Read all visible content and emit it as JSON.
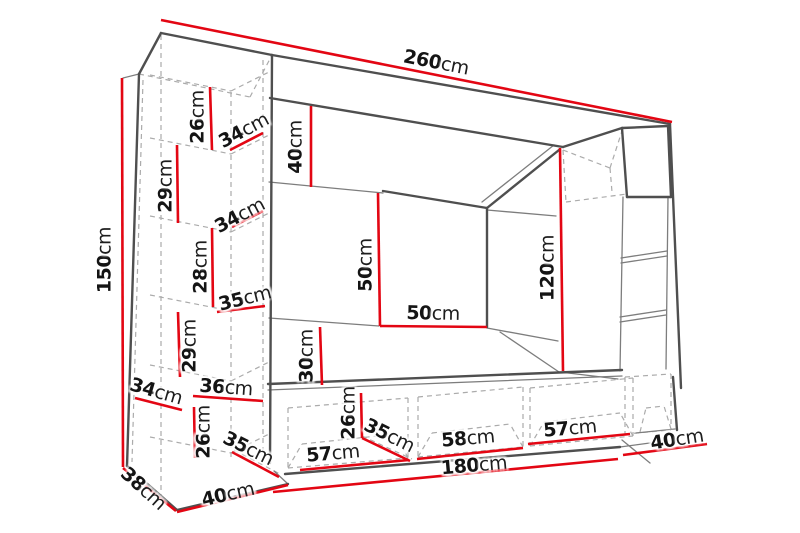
{
  "diagram": {
    "type": "furniture-dimension-drawing",
    "subject": "wall unit entertainment center with left shelf column, top panel, hanging cabinet, TV back panel and base cabinets",
    "unit": "cm",
    "colors": {
      "dimension_line": "#e30613",
      "outline": "#4f4f4f",
      "secondary_line": "#7d7d7d",
      "hidden_line": "#ababab",
      "text": "#141414",
      "background": "#ffffff"
    }
  },
  "labels": [
    {
      "name": "total-width",
      "value": "260",
      "unit": "cm"
    },
    {
      "name": "total-height",
      "value": "150",
      "unit": "cm"
    },
    {
      "name": "left-top-shelf-height",
      "value": "26",
      "unit": "cm"
    },
    {
      "name": "top-shelf-depth",
      "value": "34",
      "unit": "cm"
    },
    {
      "name": "top-panel-height",
      "value": "40",
      "unit": "cm"
    },
    {
      "name": "left-shelf-2-height",
      "value": "29",
      "unit": "cm"
    },
    {
      "name": "shelf-depth-2",
      "value": "34",
      "unit": "cm"
    },
    {
      "name": "left-shelf-3-height",
      "value": "28",
      "unit": "cm"
    },
    {
      "name": "shelf-depth-3",
      "value": "35",
      "unit": "cm"
    },
    {
      "name": "left-shelf-4-height",
      "value": "29",
      "unit": "cm"
    },
    {
      "name": "tv-panel-height",
      "value": "50",
      "unit": "cm"
    },
    {
      "name": "tv-panel-width",
      "value": "50",
      "unit": "cm"
    },
    {
      "name": "right-opening-height",
      "value": "120",
      "unit": "cm"
    },
    {
      "name": "middle-gap-height",
      "value": "30",
      "unit": "cm"
    },
    {
      "name": "bottom-left-shelf-depth",
      "value": "34",
      "unit": "cm"
    },
    {
      "name": "bottom-left-shelf-width",
      "value": "36",
      "unit": "cm"
    },
    {
      "name": "left-bottom-shelf-height",
      "value": "26",
      "unit": "cm"
    },
    {
      "name": "bottom-left-depth",
      "value": "35",
      "unit": "cm"
    },
    {
      "name": "base-cabinet-height",
      "value": "26",
      "unit": "cm"
    },
    {
      "name": "base-cabinet-depth",
      "value": "35",
      "unit": "cm"
    },
    {
      "name": "base-cabinet-1-width",
      "value": "57",
      "unit": "cm"
    },
    {
      "name": "base-cabinet-2-width",
      "value": "58",
      "unit": "cm"
    },
    {
      "name": "base-cabinet-3-width",
      "value": "57",
      "unit": "cm"
    },
    {
      "name": "right-column-depth",
      "value": "40",
      "unit": "cm"
    },
    {
      "name": "base-total-width",
      "value": "180",
      "unit": "cm"
    },
    {
      "name": "left-column-depth",
      "value": "38",
      "unit": "cm"
    },
    {
      "name": "left-column-width",
      "value": "40",
      "unit": "cm"
    }
  ]
}
